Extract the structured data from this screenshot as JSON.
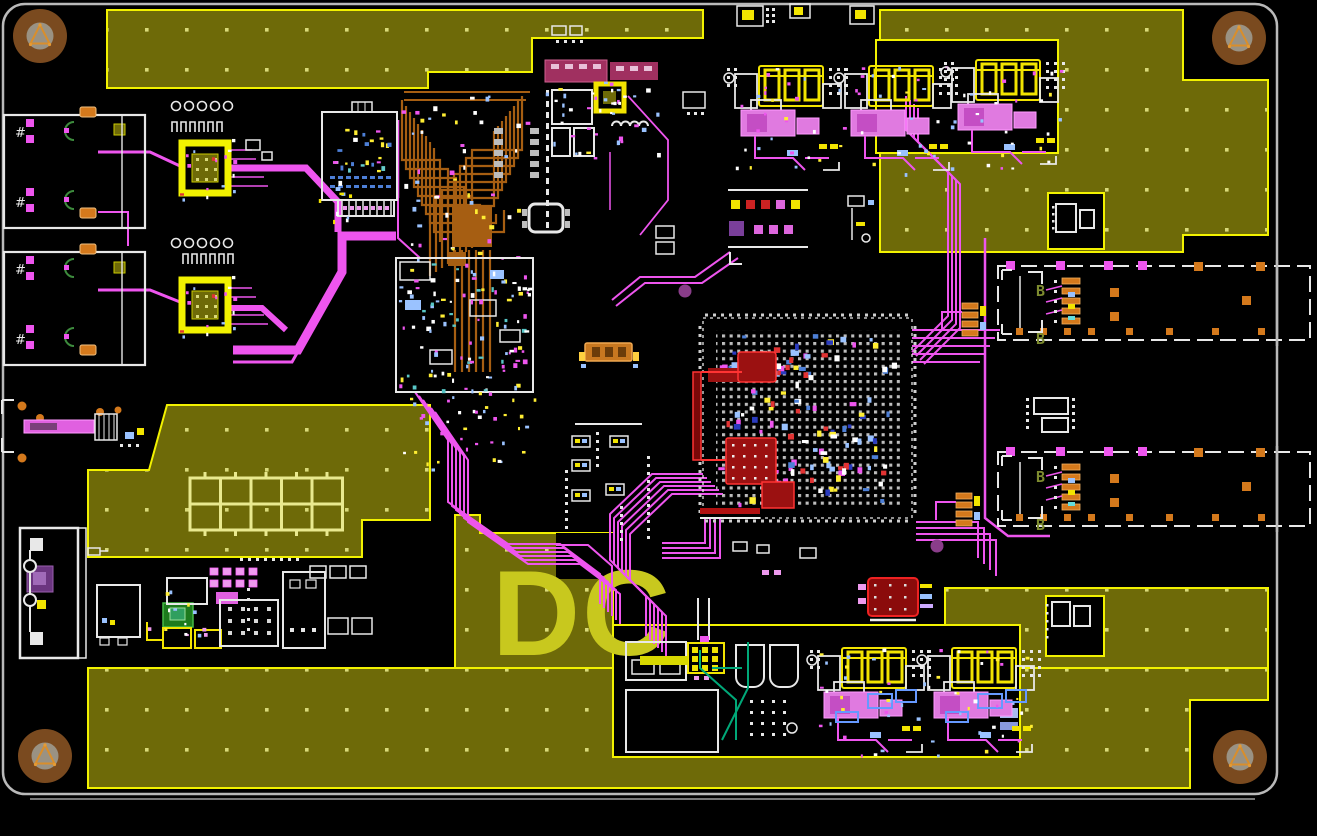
{
  "meta": {
    "description": "PCB layout editor canvas - routed circuit board top view",
    "view": "2D board view, black background"
  },
  "silkscreen": {
    "logo_text": "DC",
    "port_label": "B",
    "jack_marker": "#"
  },
  "colors": {
    "background": "#000000",
    "board_outline": "#b9b9b9",
    "pour": "#6e6a08",
    "pour_border": "#f2f200",
    "pour_dot": "#d9d978",
    "silk": "#e8e8e8",
    "silk_logo": "#c8c81e",
    "trace": "#ee55ee",
    "pad_pink": "#ee9aee",
    "inner_copper": "#a65e12",
    "pad_orange": "#d4791c",
    "pad_yellow": "#f2e400",
    "highlight_fill": "#8e0f0f",
    "highlight_stroke": "#ff3333",
    "maroon": "#a03060",
    "blue": "#4d7fd6",
    "blue_light": "#9ac2ff",
    "teal": "#00a878",
    "green_dark": "#3d8b3d",
    "label_green": "#7d8b2f",
    "violet": "#8a3d8a",
    "hole_outer": "#7a4a1f",
    "hole_inner": "#9a9283",
    "hole_symbol": "#d98e2b",
    "gray_pad": "#bdbdbd"
  },
  "layers": [
    {
      "name": "board-outline",
      "color": "#b9b9b9"
    },
    {
      "name": "top-copper-traces",
      "color": "#ee55ee"
    },
    {
      "name": "inner-layer-routing",
      "color": "#a65e12"
    },
    {
      "name": "polygon-pour-ground",
      "color": "#6e6a08"
    },
    {
      "name": "silkscreen",
      "color": "#e8e8e8"
    },
    {
      "name": "highlighted-nets",
      "color": "#ff3333"
    },
    {
      "name": "multilayer-pads",
      "color": "#d4791c"
    }
  ],
  "components": [
    {
      "name": "mounting-hole-top-left",
      "type": "mounting hole"
    },
    {
      "name": "mounting-hole-top-right",
      "type": "mounting hole"
    },
    {
      "name": "mounting-hole-bottom-left",
      "type": "mounting hole"
    },
    {
      "name": "mounting-hole-bottom-right",
      "type": "mounting hole"
    },
    {
      "name": "ethernet-jack-1",
      "type": "shielded modular jack"
    },
    {
      "name": "ethernet-jack-2",
      "type": "shielded modular jack"
    },
    {
      "name": "phy-ic-1",
      "type": "QFN IC with thermal vias"
    },
    {
      "name": "phy-ic-2",
      "type": "QFN IC with thermal vias"
    },
    {
      "name": "shielded-module",
      "type": "canned module"
    },
    {
      "name": "inner-layer-fanout",
      "type": "dense inner-layer routing block"
    },
    {
      "name": "decoupling-cluster",
      "type": "passive component cluster"
    },
    {
      "name": "main-bga-ic",
      "type": "large BGA with red-highlighted nets"
    },
    {
      "name": "edge-connector-top",
      "type": "board-edge connector"
    },
    {
      "name": "edge-connector-bottom",
      "type": "board-edge connector"
    },
    {
      "name": "power-cluster-1",
      "type": "DC-DC converter"
    },
    {
      "name": "power-cluster-2",
      "type": "DC-DC converter"
    },
    {
      "name": "power-cluster-3",
      "type": "DC-DC converter"
    },
    {
      "name": "pin-header",
      "type": "header with colored pads"
    },
    {
      "name": "dc-input-connector",
      "type": "power input connector"
    },
    {
      "name": "io-cluster-1",
      "type": "bottom interface cluster"
    },
    {
      "name": "io-cluster-2",
      "type": "bottom interface cluster"
    },
    {
      "name": "highlighted-component",
      "type": "red-highlighted part"
    },
    {
      "name": "ground-pour",
      "type": "copper polygon with thermal-relief dots"
    }
  ]
}
